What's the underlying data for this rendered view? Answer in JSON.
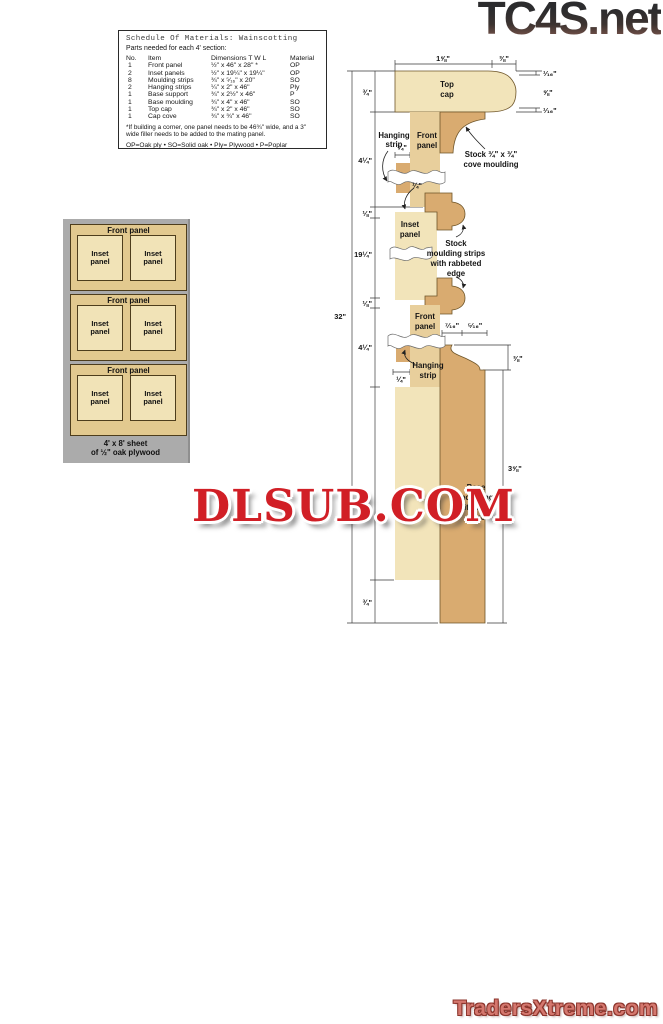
{
  "logos": {
    "tc4s": "TC4S.net",
    "dlsub": "DLSUB.COM",
    "traders": "TradersXtreme.com"
  },
  "materials": {
    "title": "Schedule Of Materials: Wainscotting",
    "subtitle": "Parts needed for each 4' section:",
    "columns": [
      "No.",
      "Item",
      "Dimensions T W L",
      "Material"
    ],
    "rows": [
      [
        "1",
        "Front panel",
        "½\" x 46\" x 28\" *",
        "OP"
      ],
      [
        "2",
        "Inset panels",
        "½\" x 19¼\" x 19¼\"",
        "OP"
      ],
      [
        "8",
        "Moulding strips",
        "¾\" x ⁵⁄₁₆\" x 20\"",
        "SO"
      ],
      [
        "2",
        "Hanging strips",
        "¼\" x 2\" x 46\"",
        "Ply"
      ],
      [
        "1",
        "Base support",
        "¾\" x 2½\" x 46\"",
        "P"
      ],
      [
        "1",
        "Base moulding",
        "¾\" x 4\" x 46\"",
        "SO"
      ],
      [
        "1",
        "Top cap",
        "¾\" x 2\" x 46\"",
        "SO"
      ],
      [
        "1",
        "Cap cove",
        "¾\" x ¾\" x 46\"",
        "SO"
      ]
    ],
    "footnote": "*If building a corner, one panel needs to be 46¾\" wide, and a 3\" wide filler needs to be added to the mating panel.",
    "legend": "OP=Oak ply • SO=Solid oak • Ply= Plywood • P=Poplar"
  },
  "sheet": {
    "front_panel_label": "Front panel",
    "inset_panel_label": "Inset panel",
    "caption_line1": "4' x 8' sheet",
    "caption_line2": "of ½\" oak plywood"
  },
  "xsection": {
    "dims": {
      "top_w1": "1⅝\"",
      "top_w2": "⅜\"",
      "r1": "¹⁄₁₆\"",
      "r2": "⅝\"",
      "r3": "¹⁄₁₆\"",
      "l1": "¾\"",
      "l2": "4¼\"",
      "l3": "⅛\"",
      "l4": "19¼\"",
      "l5": "⅛\"",
      "l6": "4¼\"",
      "l7": "¾\"",
      "overall": "32\"",
      "q1": "¼\"",
      "q2": "¼\"",
      "q3": "¼\"",
      "b1": "⁷⁄₁₆\"",
      "b2": "⁵⁄₁₆\"",
      "r4": "⅜\"",
      "r5": "3⅝\""
    },
    "labels": {
      "top_cap": [
        "Top",
        "cap"
      ],
      "hanging1": [
        "Hanging",
        "strip"
      ],
      "front1": [
        "Front",
        "panel"
      ],
      "cove": [
        "Stock ¾\" x ¾\"",
        "cove moulding"
      ],
      "inset": [
        "Inset",
        "panel"
      ],
      "strips": [
        "Stock",
        "moulding strips",
        "with rabbeted",
        "edge"
      ],
      "front2": [
        "Front",
        "panel"
      ],
      "hanging2": [
        "Hanging",
        "strip"
      ],
      "base": [
        "Base",
        "moulding",
        "with ogee",
        "edge"
      ]
    }
  }
}
